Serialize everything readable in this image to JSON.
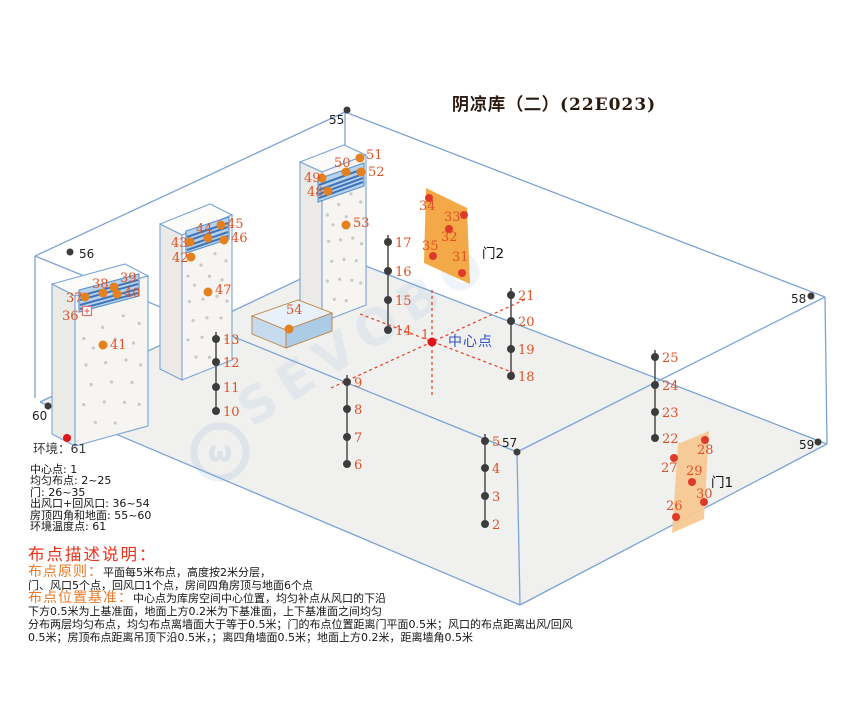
{
  "title": "阴凉库（二）(22E023)",
  "watermark": {
    "text": "SEVOBO",
    "logo": "ω"
  },
  "colors": {
    "room_line": "#7ba3d4",
    "point_dark": "#3c3c3c",
    "point_orange": "#e5801e",
    "point_red": "#de3a28",
    "center_red": "#e01616",
    "label_orange": "#dd5226",
    "dashed_red": "#e03b25",
    "door2_fill": "#f2a237",
    "door1_fill": "#f7c88f",
    "vent_blue": "#b7d2ec",
    "center_text_blue": "#3352c4"
  },
  "center_point": {
    "num": "1",
    "label": "中心点",
    "x": 432,
    "y": 342,
    "num_x": 421,
    "num_y": 339,
    "label_x": 448,
    "label_y": 346
  },
  "environment": {
    "label": "环境：",
    "num": "61",
    "dot_x": 67,
    "dot_y": 438,
    "text_x": 33,
    "text_y": 453
  },
  "corner_points": [
    {
      "num": "55",
      "x": 347,
      "y": 110,
      "lx": 329,
      "ly": 124
    },
    {
      "num": "56",
      "x": 70,
      "y": 252,
      "lx": 79,
      "ly": 258
    },
    {
      "num": "57",
      "x": 517,
      "y": 452,
      "lx": 502,
      "ly": 447
    },
    {
      "num": "58",
      "x": 811,
      "y": 296,
      "lx": 791,
      "ly": 303
    },
    {
      "num": "59",
      "x": 818,
      "y": 442,
      "lx": 799,
      "ly": 449
    },
    {
      "num": "60",
      "x": 48,
      "y": 406,
      "lx": 32,
      "ly": 420
    }
  ],
  "columns": [
    {
      "x": 388,
      "ys": [
        242,
        271,
        300,
        330
      ],
      "nums": [
        "17",
        "16",
        "15",
        "14"
      ]
    },
    {
      "x": 216,
      "ys": [
        339,
        362,
        387,
        411
      ],
      "nums": [
        "13",
        "12",
        "11",
        "10"
      ]
    },
    {
      "x": 347,
      "ys": [
        382,
        409,
        437,
        464
      ],
      "nums": [
        "9",
        "8",
        "7",
        "6"
      ]
    },
    {
      "x": 485,
      "ys": [
        441,
        468,
        496,
        524
      ],
      "nums": [
        "5",
        "4",
        "3",
        "2"
      ]
    },
    {
      "x": 511,
      "ys": [
        295,
        321,
        349,
        376
      ],
      "nums": [
        "21",
        "20",
        "19",
        "18"
      ]
    },
    {
      "x": 655,
      "ys": [
        357,
        385,
        412,
        438
      ],
      "nums": [
        "25",
        "24",
        "23",
        "22"
      ]
    }
  ],
  "vent_points": [
    {
      "num": "37",
      "x": 85,
      "y": 297,
      "lx": 66,
      "ly": 302
    },
    {
      "num": "38",
      "x": 103,
      "y": 293,
      "lx": 92,
      "ly": 288
    },
    {
      "num": "39",
      "x": 114,
      "y": 287,
      "lx": 120,
      "ly": 282
    },
    {
      "num": "40",
      "x": 117,
      "y": 294,
      "lx": 124,
      "ly": 297
    },
    {
      "num": "41",
      "x": 103,
      "y": 345,
      "lx": 110,
      "ly": 349
    },
    {
      "num": "42",
      "x": 191,
      "y": 257,
      "lx": 172,
      "ly": 262
    },
    {
      "num": "43",
      "x": 190,
      "y": 242,
      "lx": 171,
      "ly": 247
    },
    {
      "num": "44",
      "x": 208,
      "y": 238,
      "lx": 196,
      "ly": 233
    },
    {
      "num": "45",
      "x": 221,
      "y": 225,
      "lx": 227,
      "ly": 228
    },
    {
      "num": "46",
      "x": 224,
      "y": 240,
      "lx": 231,
      "ly": 242
    },
    {
      "num": "47",
      "x": 208,
      "y": 292,
      "lx": 215,
      "ly": 294
    },
    {
      "num": "48",
      "x": 328,
      "y": 191,
      "lx": 307,
      "ly": 196
    },
    {
      "num": "49",
      "x": 322,
      "y": 178,
      "lx": 304,
      "ly": 182
    },
    {
      "num": "50",
      "x": 346,
      "y": 172,
      "lx": 334,
      "ly": 167
    },
    {
      "num": "51",
      "x": 360,
      "y": 158,
      "lx": 366,
      "ly": 159
    },
    {
      "num": "52",
      "x": 361,
      "y": 172,
      "lx": 368,
      "ly": 176
    },
    {
      "num": "53",
      "x": 346,
      "y": 225,
      "lx": 353,
      "ly": 227
    },
    {
      "num": "54",
      "x": 289,
      "y": 329,
      "lx": 286,
      "ly": 314
    }
  ],
  "outlet_marker": {
    "num": "36",
    "x": 87,
    "y": 311,
    "num_x": 62,
    "num_y": 320
  },
  "doors": [
    {
      "name": "门2",
      "label_x": 482,
      "label_y": 258,
      "fill": "#f2a237",
      "quad": [
        [
          426,
          188
        ],
        [
          467,
          208
        ],
        [
          470,
          284
        ],
        [
          424,
          263
        ]
      ],
      "points": [
        {
          "num": "34",
          "x": 429,
          "y": 198,
          "lx": 419,
          "ly": 210
        },
        {
          "num": "33",
          "x": 464,
          "y": 215,
          "lx": 444,
          "ly": 221
        },
        {
          "num": "32",
          "x": 449,
          "y": 229,
          "lx": 441,
          "ly": 241
        },
        {
          "num": "35",
          "x": 433,
          "y": 256,
          "lx": 422,
          "ly": 250
        },
        {
          "num": "31",
          "x": 462,
          "y": 273,
          "lx": 452,
          "ly": 261
        }
      ]
    },
    {
      "name": "门1",
      "label_x": 711,
      "label_y": 487,
      "fill": "#f7c88f",
      "quad": [
        [
          709,
          431
        ],
        [
          678,
          444
        ],
        [
          672,
          533
        ],
        [
          704,
          519
        ]
      ],
      "points": [
        {
          "num": "28",
          "x": 705,
          "y": 440,
          "lx": 697,
          "ly": 454
        },
        {
          "num": "27",
          "x": 674,
          "y": 458,
          "lx": 661,
          "ly": 472
        },
        {
          "num": "29",
          "x": 692,
          "y": 482,
          "lx": 686,
          "ly": 475
        },
        {
          "num": "30",
          "x": 704,
          "y": 502,
          "lx": 696,
          "ly": 498
        },
        {
          "num": "26",
          "x": 676,
          "y": 517,
          "lx": 666,
          "ly": 510
        }
      ]
    }
  ],
  "legend": {
    "items": [
      "中心点: 1",
      "均匀布点: 2~25",
      "门: 26~35",
      "出风口+回风口: 36~54",
      "房顶四角和地面: 55~60",
      "环境温度点: 61"
    ]
  },
  "description": {
    "heading": "布点描述说明：",
    "lines": [
      {
        "head": "布点原则：",
        "text": "平面每5米布点，高度按2米分层，"
      },
      {
        "head": "",
        "text": "门、风口5个点，回风口1个点，房间四角房顶与地面6个点"
      },
      {
        "head": "布点位置基准：",
        "text": "中心点为库房空间中心位置，均匀补点从风口的下沿"
      },
      {
        "head": "",
        "text": "下方0.5米为上基准面，地面上方0.2米为下基准面，上下基准面之间均匀"
      },
      {
        "head": "",
        "text": "分布两层均匀布点，均匀布点离墙面大于等于0.5米；门的布点位置距离门平面0.5米；风口的布点距离出风/回风"
      },
      {
        "head": "",
        "text": "0.5米；房顶布点距离吊顶下沿0.5米，；离四角墙面0.5米；地面上方0.2米，距离墙角0.5米"
      }
    ]
  }
}
